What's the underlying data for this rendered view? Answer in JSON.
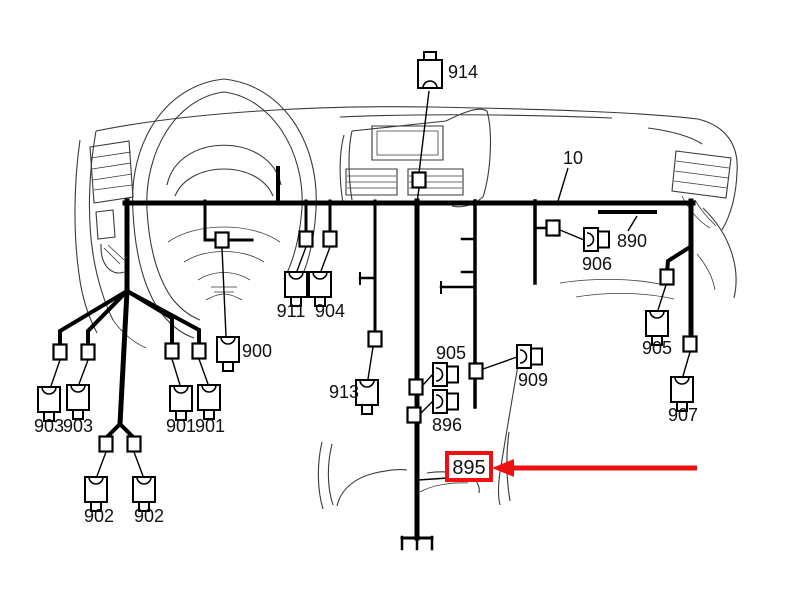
{
  "diagram": {
    "colors": {
      "wire": "#000000",
      "label": "#111111",
      "highlight": "#ee1111",
      "fill": "#ffffff"
    },
    "font_size": 18,
    "labels": [
      {
        "text": "914",
        "x": 463,
        "y": 78
      },
      {
        "text": "10",
        "x": 573,
        "y": 164
      },
      {
        "text": "890",
        "x": 632,
        "y": 247
      },
      {
        "text": "906",
        "x": 597,
        "y": 270
      },
      {
        "text": "911",
        "x": 291,
        "y": 317
      },
      {
        "text": "904",
        "x": 330,
        "y": 317
      },
      {
        "text": "900",
        "x": 257,
        "y": 357
      },
      {
        "text": "905",
        "x": 451,
        "y": 359
      },
      {
        "text": "909",
        "x": 533,
        "y": 386
      },
      {
        "text": "913",
        "x": 344,
        "y": 398
      },
      {
        "text": "896",
        "x": 447,
        "y": 431
      },
      {
        "text": "903",
        "x": 49,
        "y": 432
      },
      {
        "text": "903",
        "x": 78,
        "y": 432
      },
      {
        "text": "901",
        "x": 181,
        "y": 432
      },
      {
        "text": "901",
        "x": 210,
        "y": 432
      },
      {
        "text": "905",
        "x": 657,
        "y": 354
      },
      {
        "text": "902",
        "x": 99,
        "y": 522
      },
      {
        "text": "902",
        "x": 149,
        "y": 522
      },
      {
        "text": "907",
        "x": 683,
        "y": 421
      }
    ],
    "connectors": {
      "top_arc": [
        [
          49,
          387
        ],
        [
          78,
          385
        ],
        [
          181,
          386
        ],
        [
          209,
          385
        ],
        [
          96,
          477
        ],
        [
          144,
          477
        ],
        [
          296,
          272
        ],
        [
          320,
          272
        ],
        [
          228,
          337
        ],
        [
          367,
          380
        ],
        [
          657,
          311
        ],
        [
          682,
          377
        ]
      ],
      "top_tab": [
        [
          430,
          60
        ]
      ],
      "side": [
        [
          584,
          228
        ],
        [
          433,
          363
        ],
        [
          433,
          390
        ],
        [
          517,
          345
        ]
      ]
    },
    "clips": [
      [
        222,
        240
      ],
      [
        306,
        239
      ],
      [
        330,
        239
      ],
      [
        60,
        352
      ],
      [
        88,
        352
      ],
      [
        172,
        351
      ],
      [
        199,
        351
      ],
      [
        106,
        444
      ],
      [
        134,
        444
      ],
      [
        375,
        339
      ],
      [
        416,
        387
      ],
      [
        414,
        415
      ],
      [
        476,
        371
      ],
      [
        553,
        228
      ],
      [
        667,
        277
      ],
      [
        690,
        344
      ],
      [
        419,
        180
      ]
    ],
    "wires": [
      {
        "w": 5,
        "pts": [
          [
            125,
            203
          ],
          [
            693,
            203
          ]
        ]
      },
      {
        "w": 5,
        "pts": [
          [
            127,
            201
          ],
          [
            127,
            291
          ]
        ]
      },
      {
        "w": 4,
        "pts": [
          [
            127,
            291
          ],
          [
            60,
            331
          ],
          [
            60,
            346
          ]
        ]
      },
      {
        "w": 4,
        "pts": [
          [
            127,
            291
          ],
          [
            88,
            331
          ],
          [
            88,
            346
          ]
        ]
      },
      {
        "w": 4,
        "pts": [
          [
            127,
            291
          ],
          [
            172,
            318
          ],
          [
            172,
            345
          ]
        ]
      },
      {
        "w": 4,
        "pts": [
          [
            127,
            291
          ],
          [
            199,
            330
          ],
          [
            199,
            345
          ]
        ]
      },
      {
        "w": 5,
        "pts": [
          [
            127,
            291
          ],
          [
            120,
            424
          ]
        ]
      },
      {
        "w": 4,
        "pts": [
          [
            120,
            424
          ],
          [
            106,
            438
          ]
        ]
      },
      {
        "w": 4,
        "pts": [
          [
            120,
            424
          ],
          [
            134,
            438
          ]
        ]
      },
      {
        "w": 3,
        "pts": [
          [
            205,
            201
          ],
          [
            205,
            240
          ],
          [
            216,
            240
          ]
        ]
      },
      {
        "w": 3,
        "pts": [
          [
            228,
            240
          ],
          [
            252,
            240
          ]
        ]
      },
      {
        "w": 3,
        "pts": [
          [
            306,
            201
          ],
          [
            306,
            233
          ]
        ]
      },
      {
        "w": 3,
        "pts": [
          [
            330,
            201
          ],
          [
            330,
            233
          ]
        ]
      },
      {
        "w": 4,
        "pts": [
          [
            278,
            168
          ],
          [
            278,
            203
          ]
        ]
      },
      {
        "w": 3,
        "pts": [
          [
            375,
            201
          ],
          [
            375,
            333
          ]
        ]
      },
      {
        "w": 2.5,
        "pts": [
          [
            360,
            278
          ],
          [
            375,
            278
          ]
        ]
      },
      {
        "w": 2,
        "pts": [
          [
            360,
            273
          ],
          [
            360,
            284
          ]
        ]
      },
      {
        "w": 5,
        "pts": [
          [
            417,
            201
          ],
          [
            417,
            538
          ]
        ]
      },
      {
        "w": 3,
        "pts": [
          [
            402,
            538
          ],
          [
            432,
            538
          ]
        ]
      },
      {
        "w": 2.5,
        "pts": [
          [
            402,
            537
          ],
          [
            402,
            549
          ]
        ]
      },
      {
        "w": 2.5,
        "pts": [
          [
            432,
            537
          ],
          [
            432,
            549
          ]
        ]
      },
      {
        "w": 2.5,
        "pts": [
          [
            417,
            538
          ],
          [
            417,
            549
          ]
        ]
      },
      {
        "w": 3.5,
        "pts": [
          [
            475,
            201
          ],
          [
            475,
            407
          ]
        ]
      },
      {
        "w": 2.5,
        "pts": [
          [
            462,
            239
          ],
          [
            475,
            239
          ]
        ]
      },
      {
        "w": 2.5,
        "pts": [
          [
            462,
            272
          ],
          [
            475,
            272
          ]
        ]
      },
      {
        "w": 2.5,
        "pts": [
          [
            441,
            287
          ],
          [
            475,
            287
          ]
        ]
      },
      {
        "w": 2,
        "pts": [
          [
            441,
            282
          ],
          [
            441,
            293
          ]
        ]
      },
      {
        "w": 3.5,
        "pts": [
          [
            535,
            201
          ],
          [
            535,
            283
          ]
        ]
      },
      {
        "w": 2.5,
        "pts": [
          [
            535,
            228
          ],
          [
            548,
            228
          ]
        ]
      },
      {
        "w": 5,
        "pts": [
          [
            691,
            201
          ],
          [
            691,
            338
          ]
        ]
      },
      {
        "w": 4,
        "pts": [
          [
            690,
            247
          ],
          [
            668,
            261
          ],
          [
            667,
            272
          ]
        ]
      },
      {
        "w": 4,
        "pts": [
          [
            600,
            212
          ],
          [
            655,
            212
          ]
        ]
      }
    ],
    "leaders": [
      [
        [
          429,
          91
        ],
        [
          419,
          173
        ]
      ],
      [
        [
          419,
          188
        ],
        [
          417,
          203
        ]
      ],
      [
        [
          568,
          168
        ],
        [
          558,
          201
        ]
      ],
      [
        [
          637,
          216
        ],
        [
          628,
          231
        ]
      ],
      [
        [
          222,
          248
        ],
        [
          226,
          336
        ]
      ],
      [
        [
          306,
          247
        ],
        [
          297,
          271
        ]
      ],
      [
        [
          330,
          247
        ],
        [
          321,
          271
        ]
      ],
      [
        [
          373,
          347
        ],
        [
          368,
          379
        ]
      ],
      [
        [
          60,
          360
        ],
        [
          51,
          386
        ]
      ],
      [
        [
          88,
          360
        ],
        [
          79,
          384
        ]
      ],
      [
        [
          172,
          359
        ],
        [
          180,
          385
        ]
      ],
      [
        [
          199,
          359
        ],
        [
          208,
          384
        ]
      ],
      [
        [
          106,
          452
        ],
        [
          97,
          476
        ]
      ],
      [
        [
          134,
          452
        ],
        [
          143,
          476
        ]
      ],
      [
        [
          560,
          230
        ],
        [
          584,
          240
        ]
      ],
      [
        [
          423,
          385
        ],
        [
          433,
          374
        ]
      ],
      [
        [
          421,
          413
        ],
        [
          433,
          401
        ]
      ],
      [
        [
          483,
          369
        ],
        [
          517,
          357
        ]
      ],
      [
        [
          666,
          285
        ],
        [
          658,
          310
        ]
      ],
      [
        [
          690,
          352
        ],
        [
          683,
          376
        ]
      ],
      [
        [
          448,
          478
        ],
        [
          418,
          480
        ]
      ]
    ],
    "callout": {
      "label": "895",
      "label_x": 469,
      "label_y": 474,
      "label_size": 20,
      "box": {
        "x": 447,
        "y": 453,
        "w": 44,
        "h": 27
      },
      "arrow": {
        "x1": 697,
        "y1": 468,
        "x2": 506,
        "y2": 468
      },
      "arrow_head": "492,468 514,459 514,477"
    }
  }
}
